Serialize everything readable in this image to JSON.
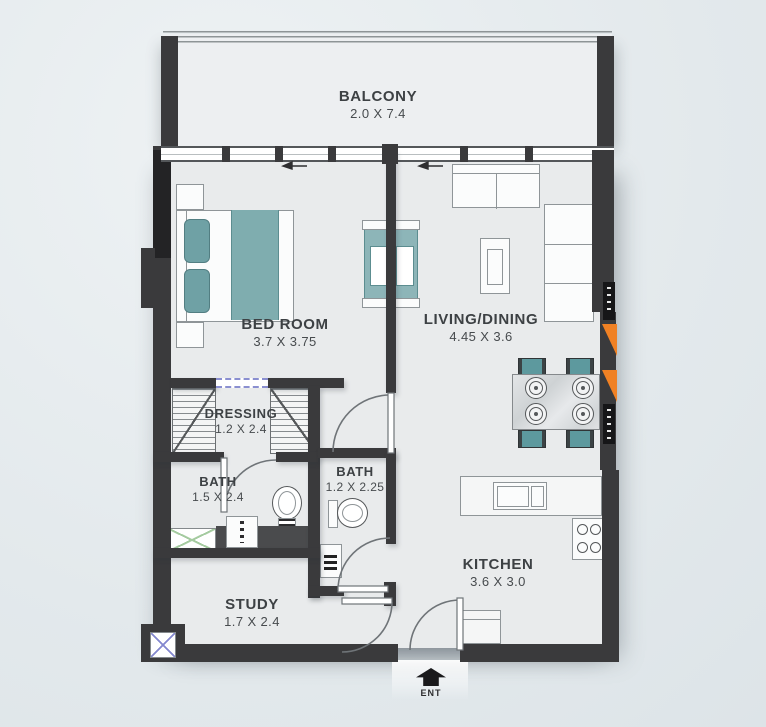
{
  "plan": {
    "title": "apartment-floor-plan",
    "rooms": [
      {
        "id": "balcony",
        "label": "BALCONY",
        "dims": "2.0 X 7.4"
      },
      {
        "id": "bedroom",
        "label": "BED ROOM",
        "dims": "3.7 X 3.75"
      },
      {
        "id": "living_dining",
        "label": "LIVING/DINING",
        "dims": "4.45 X 3.6"
      },
      {
        "id": "dressing",
        "label": "DRESSING",
        "dims": "1.2 X 2.4"
      },
      {
        "id": "bath_1",
        "label": "BATH",
        "dims": "1.5 X 2.4"
      },
      {
        "id": "bath_2",
        "label": "BATH",
        "dims": "1.2 X 2.25"
      },
      {
        "id": "study",
        "label": "STUDY",
        "dims": "1.7 X 2.4"
      },
      {
        "id": "kitchen",
        "label": "KITCHEN",
        "dims": "3.6 X 3.0"
      }
    ],
    "entrance": {
      "label": "ENT"
    },
    "colors": {
      "wall": "#3a3a3c",
      "floor": "#e9ebec",
      "background": "#e3e9ec",
      "accent_teal": "#74a4a7",
      "accent_orange": "#f08124",
      "dashed_opening_blue": "#8a8fd0",
      "shaft_green": "#a5cba0"
    }
  }
}
